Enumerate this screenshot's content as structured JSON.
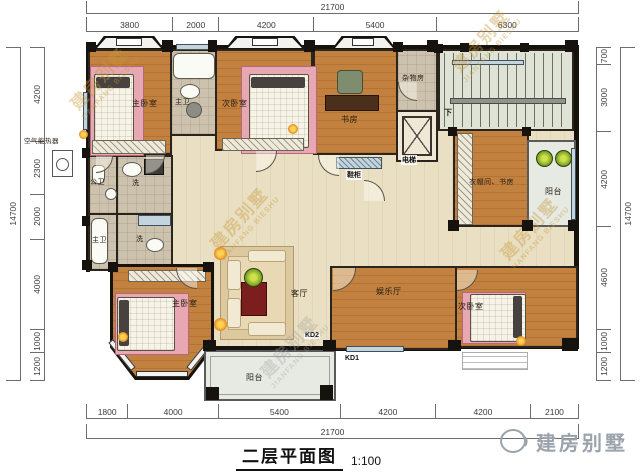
{
  "title": {
    "name": "二层平面图",
    "scale": "1:100"
  },
  "watermark": {
    "cn": "建房别墅",
    "en": "JIANFANG BIESHU"
  },
  "logo": {
    "text": "建房别墅"
  },
  "annotations": {
    "heater": "空气能热器",
    "down": "下",
    "kd1": "KD1",
    "kd2": "KD2"
  },
  "rooms": {
    "master_bedroom_top": {
      "label": "主卧室"
    },
    "master_bath_top": {
      "label": "主卫"
    },
    "second_bedroom_top": {
      "label": "次卧室"
    },
    "study": {
      "label": "书房"
    },
    "storage": {
      "label": "杂物房"
    },
    "elevator": {
      "label": "电梯"
    },
    "shoe_cabinet": {
      "label": "鞋柜"
    },
    "cloakroom_study": {
      "label": "衣帽间、书房"
    },
    "balcony_right": {
      "label": "阳台"
    },
    "public_bath": {
      "label": "公卫"
    },
    "laundry_top": {
      "label": "洗"
    },
    "master_bath_left": {
      "label": "主卫"
    },
    "laundry_bottom": {
      "label": "洗"
    },
    "master_bedroom_bottom": {
      "label": "主卧室"
    },
    "living_room": {
      "label": "客厅"
    },
    "entertainment_hall": {
      "label": "娱乐厅"
    },
    "second_bedroom_bottom": {
      "label": "次卧室"
    },
    "balcony_bottom": {
      "label": "阳台"
    }
  },
  "dimensions": {
    "top": {
      "overall": "21700",
      "segments": [
        "3800",
        "2000",
        "4200",
        "5400",
        "6300"
      ]
    },
    "bottom": {
      "overall": "21700",
      "segments": [
        "1800",
        "4000",
        "5400",
        "4200",
        "4200",
        "2100"
      ]
    },
    "left": {
      "overall": "14700",
      "segments": [
        "4200",
        "2300",
        "2000",
        "4000",
        "1000",
        "1200"
      ]
    },
    "right": {
      "overall": "14700",
      "segments": [
        "700",
        "3000",
        "4200",
        "4600",
        "1000",
        "1200"
      ]
    }
  },
  "colors": {
    "wall": "#16120e",
    "wood_floor": "#c2813f",
    "corridor_floor": "#e9dfc2",
    "bath_floor": "#cdc2ae",
    "stair_floor": "#dfe3d6",
    "balcony_floor": "#e6eae3",
    "rug_pink": "#e7a7b3",
    "watermark_gold": "#c9983a",
    "dimension_text": "#3a3a3a"
  }
}
